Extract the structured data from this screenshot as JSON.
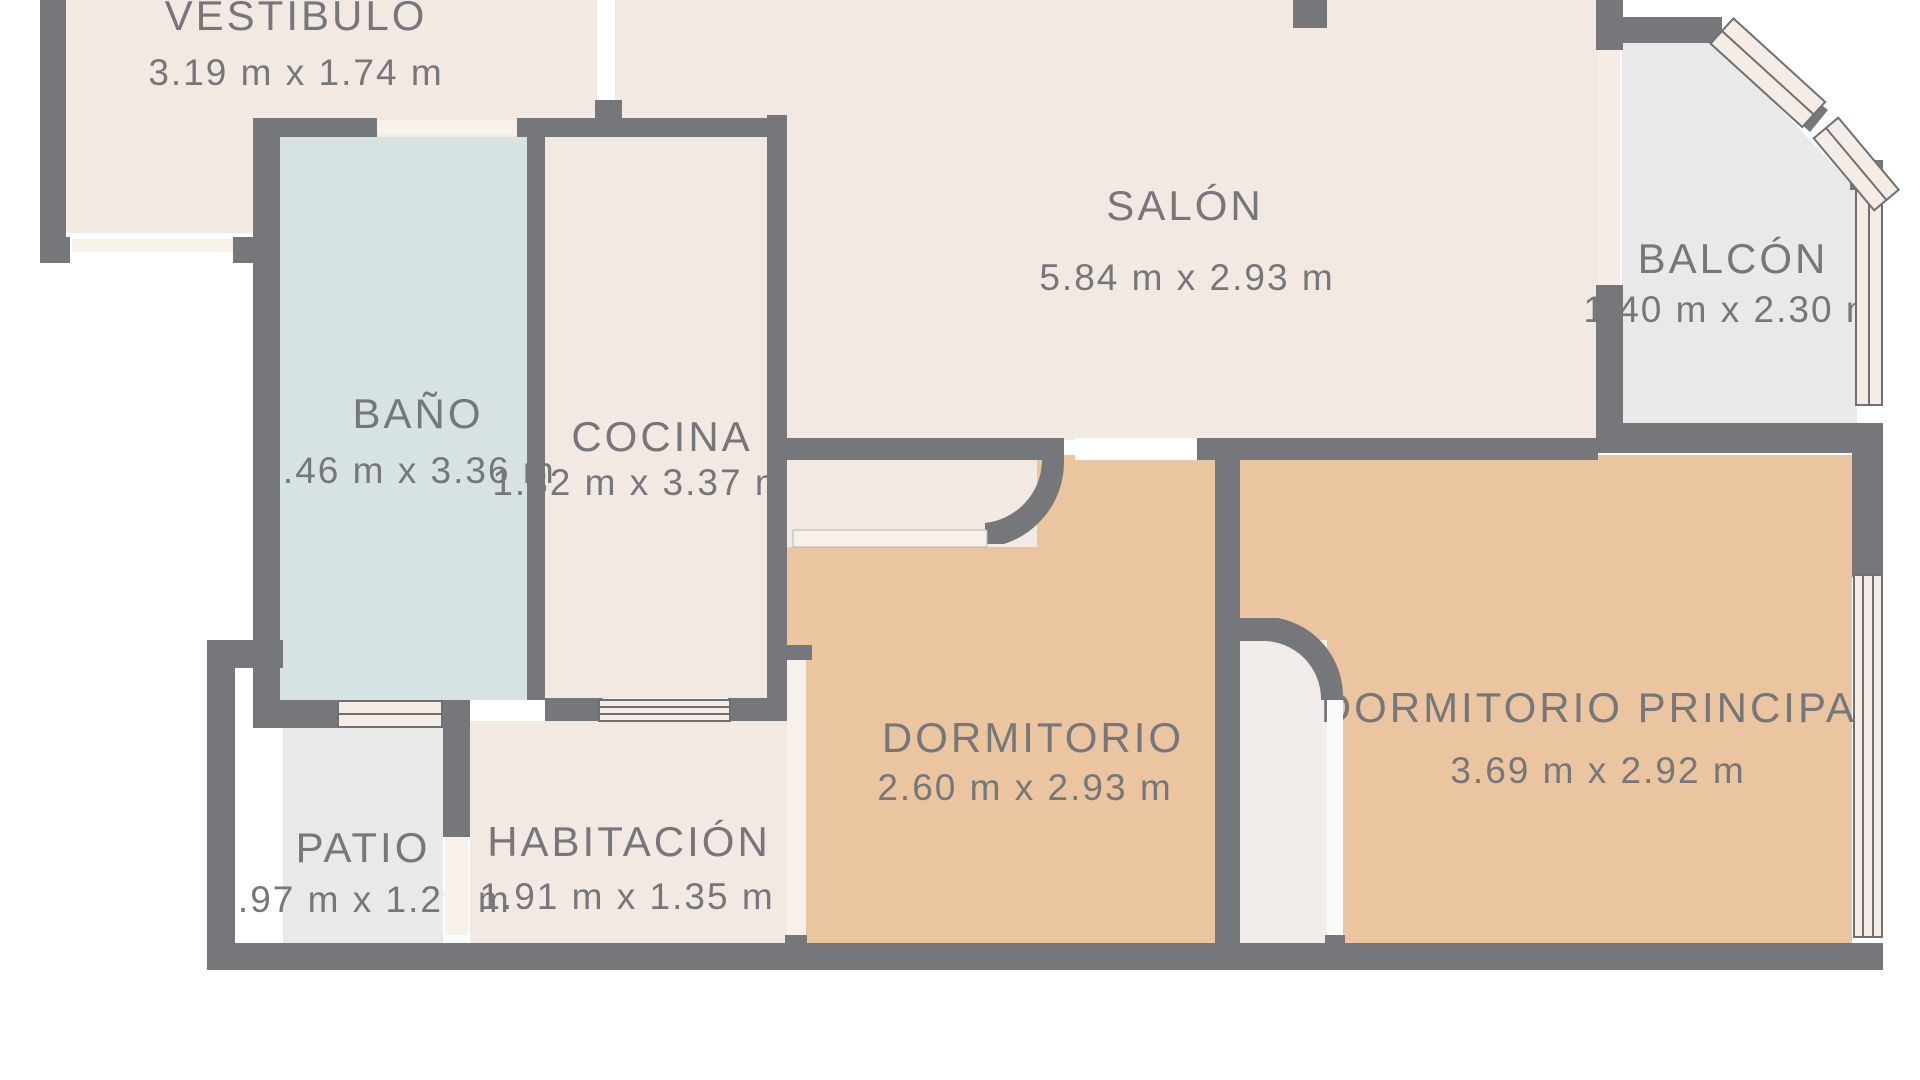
{
  "floorplan": {
    "type": "apartment-floor-plan",
    "units": "m",
    "rooms": [
      {
        "name": "VESTÍBULO",
        "dims": "3.19 m x 1.74 m",
        "floor_color_key": "cream"
      },
      {
        "name": "BAÑO",
        "dims": "1.46 m x 3.36 m",
        "floor_color_key": "blue"
      },
      {
        "name": "COCINA",
        "dims": "1.32 m x 3.37 m",
        "floor_color_key": "cream"
      },
      {
        "name": "SALÓN",
        "dims": "5.84 m x 2.93 m",
        "floor_color_key": "cream"
      },
      {
        "name": "BALCÓN",
        "dims": "1.40 m x 2.30 m",
        "floor_color_key": "gray"
      },
      {
        "name": "PATIO",
        "dims": "0.97 m x 1.29 m",
        "floor_color_key": "gray"
      },
      {
        "name": "HABITACIÓN",
        "dims": "1.91 m x 1.35 m",
        "floor_color_key": "cream"
      },
      {
        "name": "DORMITORIO",
        "dims": "2.60 m x 2.93 m",
        "floor_color_key": "tan"
      },
      {
        "name": "DORMITORIO PRINCIPAL",
        "dims": "3.69 m x 2.92 m",
        "floor_color_key": "tan"
      }
    ],
    "colors": {
      "wall": "#76777a",
      "cream": "#f3e9e3",
      "tan": "#eac5a0",
      "blue": "#d7e3e2",
      "gray": "#e9e9ea",
      "opening": "#f8f1ea",
      "window_fill": "#f5ece5",
      "line": "#6f7072",
      "text": "#76777a",
      "background": "#ffffff"
    }
  }
}
